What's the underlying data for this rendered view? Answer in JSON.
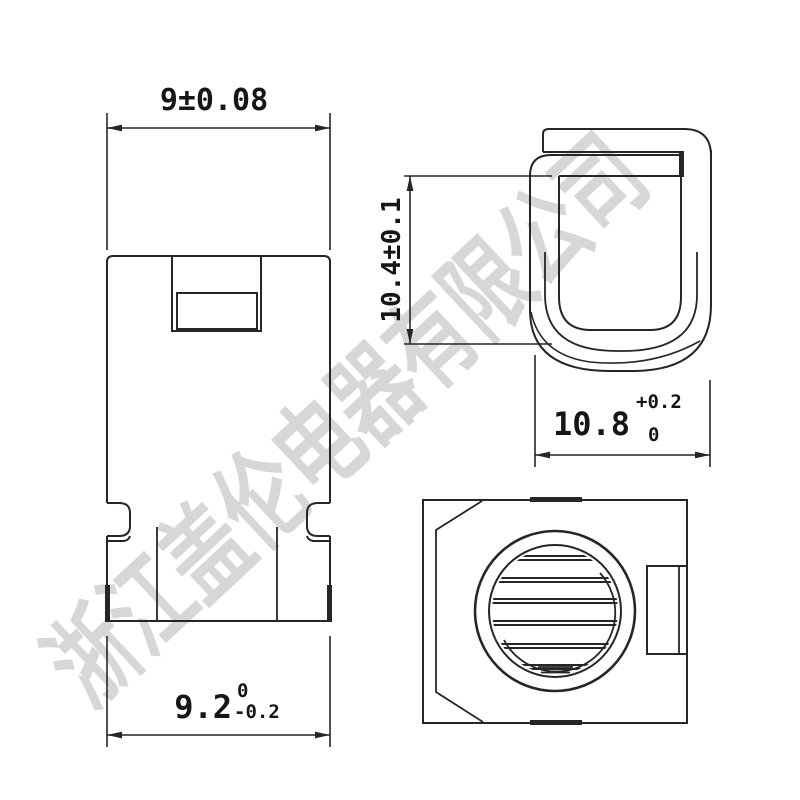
{
  "document": {
    "type": "engineering-drawing",
    "views": {
      "front": "front-view",
      "side": "side-view",
      "bottom": "bottom-view"
    }
  },
  "watermark": {
    "text": "浙江盖伦电器有限公司",
    "color": "#d7d7d7"
  },
  "colors": {
    "line": "#262626",
    "text": "#161616",
    "background": "#ffffff"
  },
  "dimensions": {
    "front_top_width": {
      "text": "9±0.08"
    },
    "front_bottom_width": {
      "value": "9.2",
      "upper": "0",
      "lower": "-0.2"
    },
    "side_height": {
      "text": "10.4±0.1"
    },
    "side_width": {
      "value": "10.8",
      "upper": "+0.2",
      "lower": "0"
    }
  }
}
